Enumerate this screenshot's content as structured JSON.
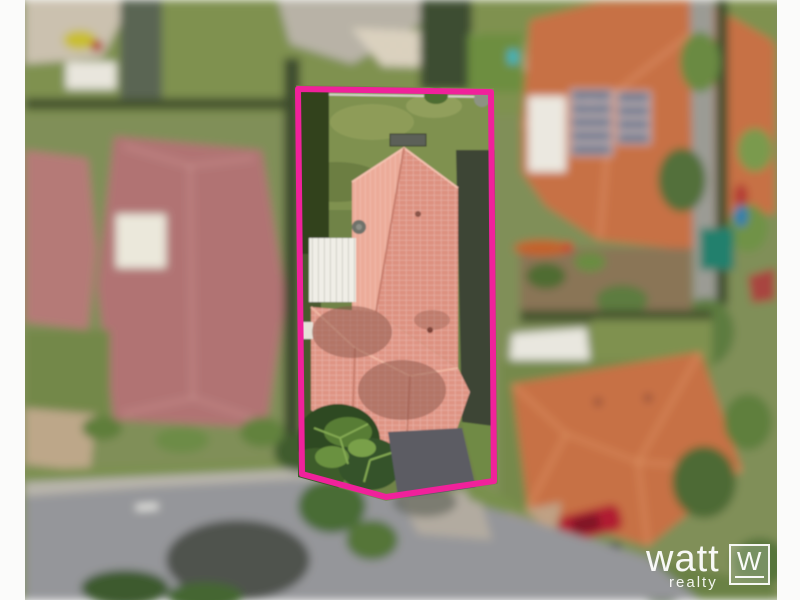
{
  "scene": {
    "kind": "aerial-drone-photo-of-residential-property",
    "highlight": "single lot outlined in pink, neighbouring houses blurred"
  },
  "watermark": {
    "brand": "watt",
    "tagline": "realty",
    "monogram": "W"
  },
  "colors": {
    "boundary_pink": "#f0219b",
    "subject_roof": "#ecab99",
    "subject_roof_tiles": "#dd9180",
    "carport_white": "#f0eee7",
    "neighbor_left_roof": "#b17373",
    "neighbor_orange_roof": "#c77144",
    "solar_panel_blue": "#66758b",
    "teal_shed": "#23806d",
    "lawn_green": "#7f9150",
    "road_gray": "#95969a",
    "watermark_white": "#ffffff"
  }
}
